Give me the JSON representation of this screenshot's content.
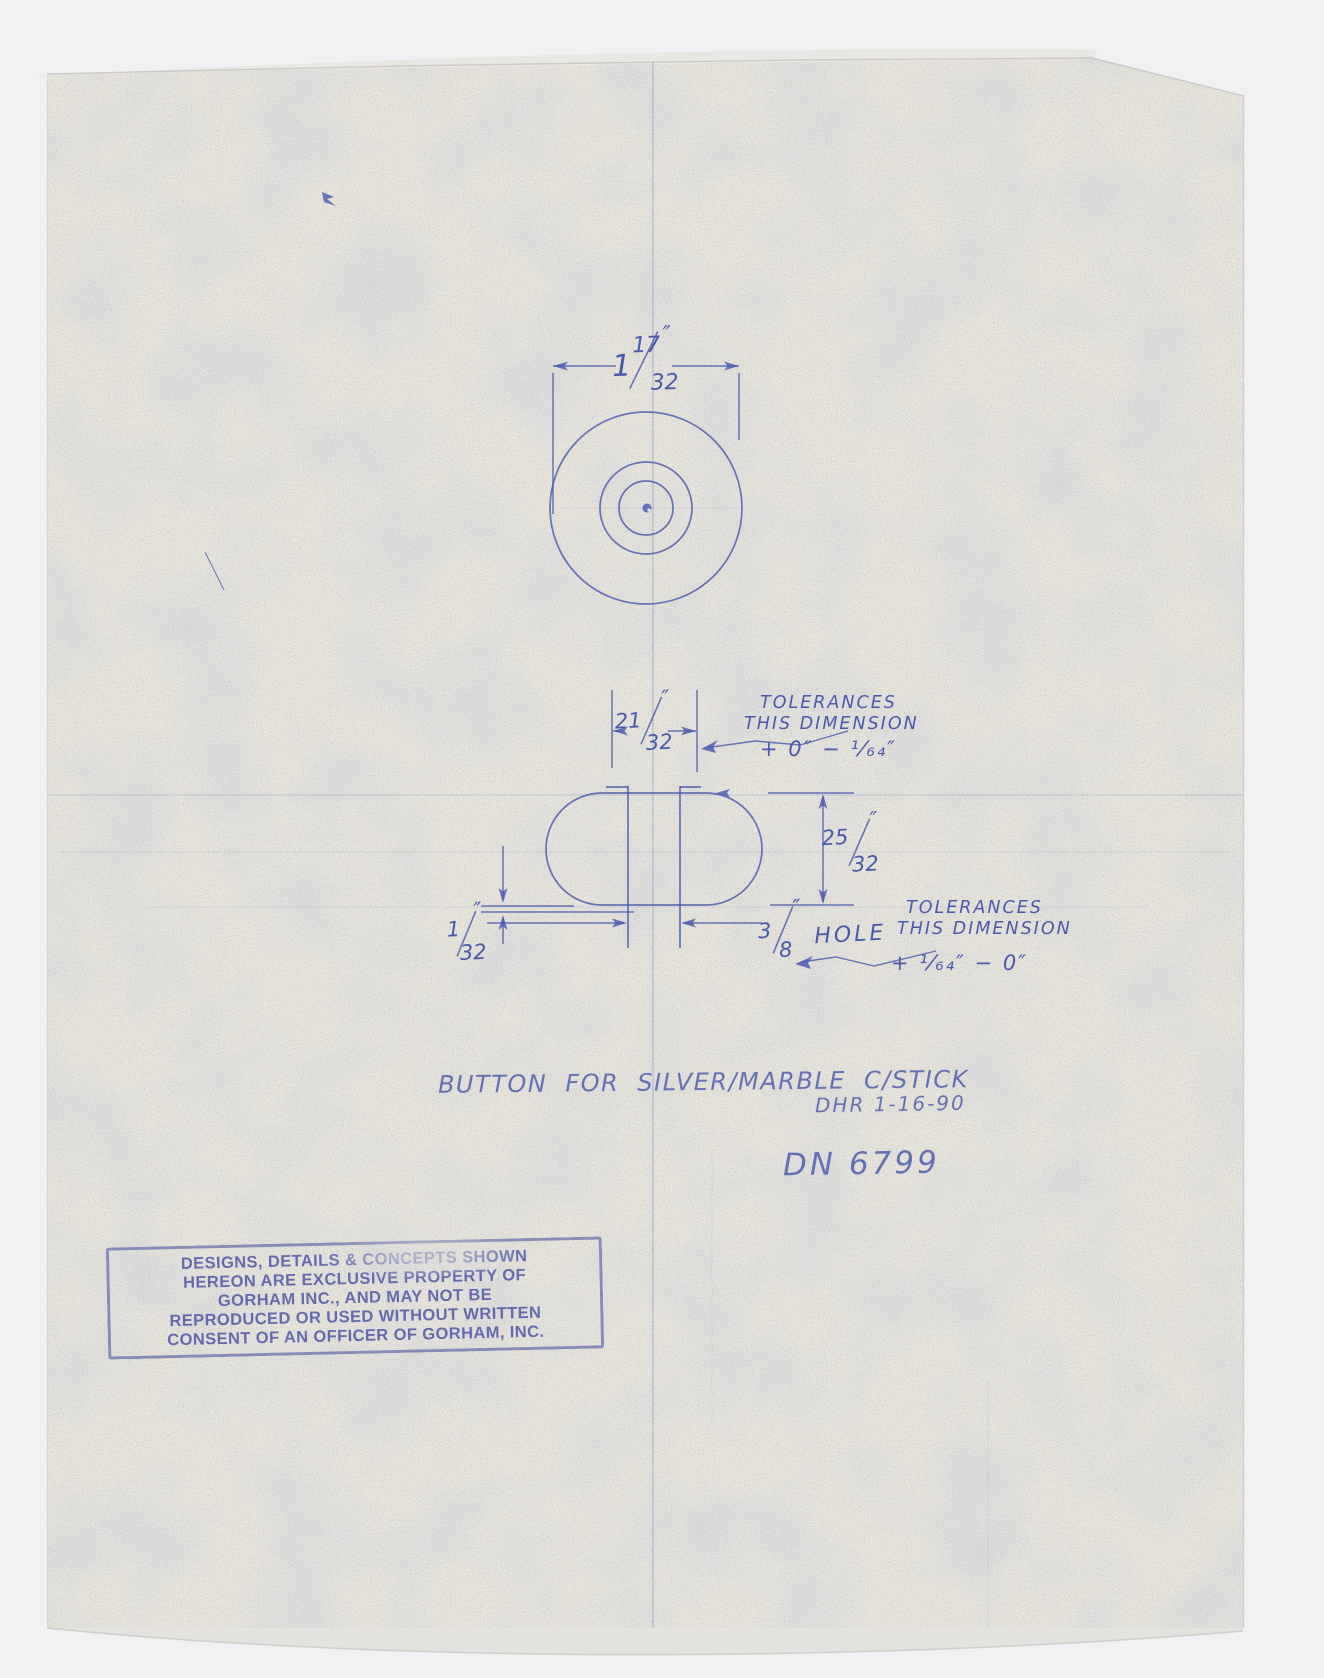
{
  "palette": {
    "ink": "#4a59ac",
    "paper": "#eae6d8",
    "backdrop": "#f1f0f2",
    "stamp_ink": "#545ba8"
  },
  "top_view": {
    "diameter_dim": {
      "whole": "1",
      "num": "17",
      "den": "32",
      "unit": "″"
    }
  },
  "side_view": {
    "width_dim": {
      "num": "21",
      "den": "32",
      "unit": "″"
    },
    "height_dim": {
      "num": "25",
      "den": "32",
      "unit": "″"
    },
    "land_dim": {
      "num": "1",
      "den": "32",
      "unit": "″"
    },
    "hole_dim": {
      "num": "3",
      "den": "8",
      "unit": "″",
      "label": "HOLE"
    },
    "tolerance_note_top": {
      "line1": "TOLERANCES",
      "line2": "THIS DIMENSION",
      "line3": "+ 0″ − ¹⁄₆₄″"
    },
    "tolerance_note_bottom": {
      "line1": "TOLERANCES",
      "line2": "THIS DIMENSION",
      "line3": "+ ¹⁄₆₄″ − 0″"
    }
  },
  "annotations": {
    "title": "BUTTON FOR SILVER/MARBLE C/STICK",
    "author_date": "DHR 1-16-90",
    "drawing_number": "DN 6799"
  },
  "stamp": {
    "lines": [
      "DESIGNS, DETAILS & CONCEPTS SHOWN",
      "HEREON ARE EXCLUSIVE PROPERTY OF",
      "GORHAM INC., AND MAY NOT BE",
      "REPRODUCED OR USED WITHOUT WRITTEN",
      "CONSENT OF AN OFFICER OF GORHAM, INC."
    ]
  }
}
